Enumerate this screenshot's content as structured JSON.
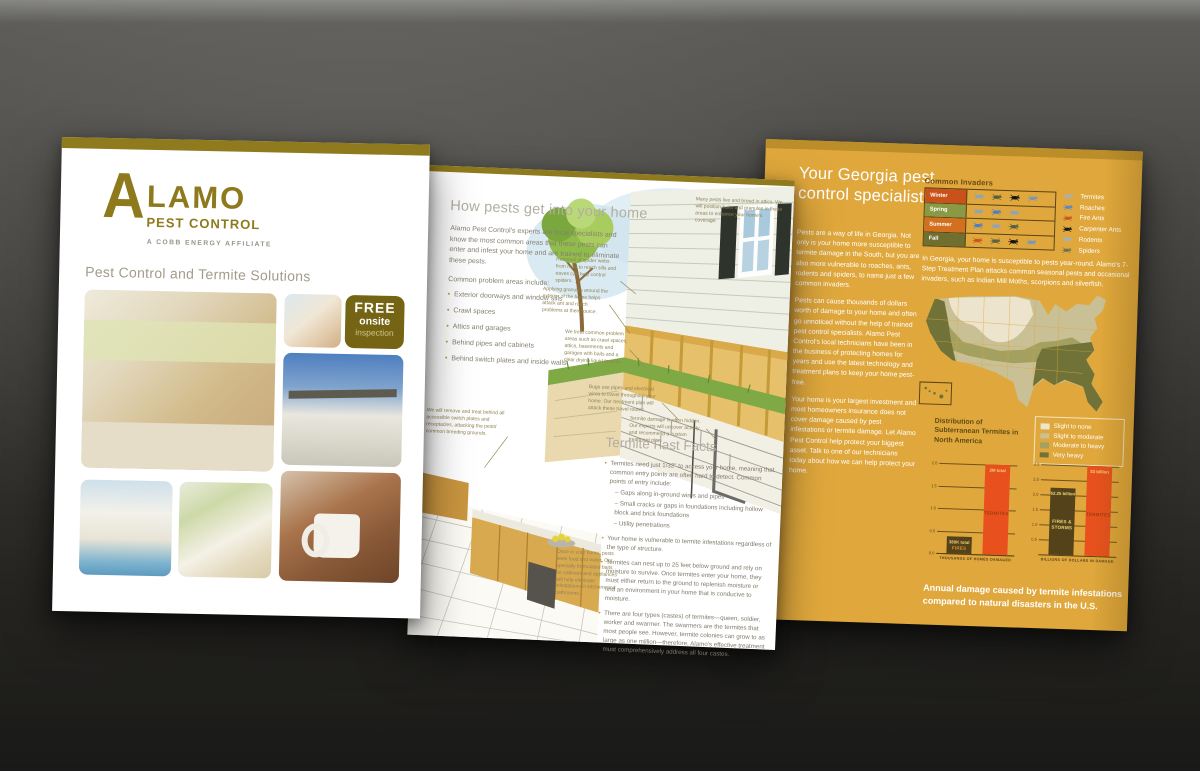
{
  "page1": {
    "logo": {
      "initial": "A",
      "word": "LAMO",
      "sub": "PEST CONTROL",
      "tagline": "A COBB ENERGY AFFILIATE"
    },
    "heading": "Pest Control and Termite Solutions",
    "badge": {
      "line1": "FREE",
      "line2": "onsite",
      "line3": "inspection"
    },
    "photos": [
      "family cooking in kitchen",
      "parents and daughter",
      "two-story house",
      "house with pool",
      "woman with dog",
      "woman holding mug"
    ]
  },
  "page2": {
    "heading": "How pests get into your home",
    "intro": "Alamo Pest Control's experts are local specialists and know the most common areas that these pests can enter and infest your home and are trained to eliminate these pests.",
    "list_intro": "Common problem areas include:",
    "bullets": [
      "Exterior doorways and window sills",
      "Crawl spaces",
      "Attics and garages",
      "Behind pipes and cabinets",
      "Behind switch plates and inside walls"
    ],
    "annotations": {
      "attic": "Many pests live and breed in attics. We will position baits and granules in these areas to enhance your home's coverage.",
      "spider": "Removal of spider webs from hard to reach sills and eaves can help control spiders.",
      "granules": "Applying granules around the exterior of the home helps attack ant and roach problems at their source.",
      "treat": "We treat common problem areas such as crawl spaces, attics, basements and garages with baits and a clear drying liquid formula.",
      "switches": "We will remove and treat behind all accessible switch plates and receptacles, attacking the pests' common breeding grounds.",
      "pipes": "Bugs use pipes and electrical wires to travel throughout your home. Our treatment plan will attack these travel routes.",
      "hidden": "Termite damage is often hidden. Our experts will uncover activity and recommend a custom treatment plan.",
      "kitchen": "Once in your home, pests seek food and water. Our specially formulated baits for cabinets and appliances will help eliminate infestations in kitchens and bathrooms."
    },
    "facts_heading": "Termite Fast Facts",
    "facts": [
      {
        "text": "Termites need just 1/32\" to access your home, meaning that common entry points are often hard to detect. Common points of entry include:",
        "subs": [
          "– Gaps along in-ground wires and pipes",
          "– Small cracks or gaps in foundations including hollow block and brick foundations",
          "– Utility penetrations"
        ]
      },
      {
        "text": "Your home is vulnerable to termite infestations regardless of the type of structure."
      },
      {
        "text": "Termites can nest up to 25 feet below ground and rely on moisture to survive. Once termites enter your home, they must either return to the ground to replenish moisture or find an environment in your home that is conducive to moisture."
      },
      {
        "text": "There are four types (castes) of termites—queen, soldier, worker and swarmer. The swarmers are the termites that most people see. However, termite colonies can grow to as large as one million—therefore, Alamo's effective treatment must comprehensively address all four castes."
      }
    ]
  },
  "page3": {
    "heading_line1": "Your Georgia pest",
    "heading_line2": "control specialists",
    "paragraphs": [
      "Pests are a way of life in Georgia. Not only is your home more susceptible to termite damage in the South, but you are also more vulnerable to roaches, ants, rodents and spiders, to name just a few common invaders.",
      "Pests can cause thousands of dollars worth of damage to your home and often go unnoticed without the help of trained pest control specialists. Alamo Pest Control's local technicians have been in the business of protecting homes for years and use the latest technology and treatment plans to keep your home pest-free.",
      "Your home is your largest investment and most homeowners insurance does not cover damage caused by pest infestations or termite damage. Let Alamo Pest Control help protect your biggest asset. Talk to one of our technicians today about how we can help protect your home."
    ],
    "invaders": {
      "title": "Common Invaders",
      "rows": [
        {
          "label": "Winter",
          "label_color": "#c8521a",
          "icons": [
            "#8ba3bd",
            "#555d42",
            "#151515",
            "#7b97b4"
          ]
        },
        {
          "label": "Spring",
          "label_color": "#8a9a44",
          "icons": [
            "#8ba3bd",
            "#4f7ec9",
            "#8ba3bd"
          ]
        },
        {
          "label": "Summer",
          "label_color": "#d3701f",
          "icons": [
            "#4f7ec9",
            "#8ba3bd",
            "#555d42"
          ]
        },
        {
          "label": "Fall",
          "label_color": "#6f7030",
          "icons": [
            "#c8561e",
            "#5a6140",
            "#151515",
            "#7b97b4"
          ]
        }
      ],
      "legend": [
        {
          "label": "Termites",
          "color": "#9fb3c5"
        },
        {
          "label": "Roaches",
          "color": "#5f86c0"
        },
        {
          "label": "Fire Ants",
          "color": "#c8561e"
        },
        {
          "label": "Carpenter Ants",
          "color": "#1a1a1a"
        },
        {
          "label": "Rodents",
          "color": "#9fb3c5"
        },
        {
          "label": "Spiders",
          "color": "#6e744e"
        }
      ]
    },
    "georgia_note": "In Georgia, your home is susceptible to pests year-round. Alamo's 7-Step Treatment Plan attacks common seasonal pests and occasional invaders, such as Indian Mill Moths, scorpions and silverfish.",
    "map_title": "Distribution of Subterranean Termites in North America",
    "map_legend": [
      {
        "label": "Slight to none",
        "color": "#ece4cd"
      },
      {
        "label": "Slight to moderate",
        "color": "#c9c096"
      },
      {
        "label": "Moderate to heavy",
        "color": "#a3a060"
      },
      {
        "label": "Very heavy",
        "color": "#707238"
      }
    ],
    "caption": "Annual damage caused by termite infestations compared to natural disasters in the U.S."
  },
  "chart_data": [
    {
      "type": "bar",
      "title": "Homes damaged annually",
      "xlabel": "THOUSANDS OF HOMES DAMAGED",
      "ylabel": "",
      "ylim": [
        0,
        2.0
      ],
      "yticks": [
        0.0,
        0.5,
        1.0,
        1.5,
        2.0
      ],
      "grid": true,
      "bars": [
        {
          "name": "FIRES",
          "value": 0.38,
          "value_label": "380K total",
          "color": "#54431a",
          "value_color": "#f2d479",
          "name_color": "#e08a2e"
        },
        {
          "name": "TERMITES",
          "value": 2.0,
          "value_label": "2M total",
          "color": "#e8511d",
          "value_color": "#f2d479",
          "name_color": "#a23c10"
        }
      ]
    },
    {
      "type": "bar",
      "title": "Dollars of damage annually",
      "xlabel": "BILLIONS OF DOLLARS IN DAMAGE",
      "ylabel": "",
      "ylim": [
        0,
        3.0
      ],
      "yticks": [
        0.5,
        1.0,
        1.5,
        2.0,
        2.5,
        3.0
      ],
      "grid": true,
      "bars": [
        {
          "name": "FIRES & STORMS",
          "value": 2.25,
          "value_label": "$2.25 billion",
          "color": "#54431a",
          "value_color": "#f2d479",
          "name_color": "#f2d479"
        },
        {
          "name": "TERMITES",
          "value": 3.0,
          "value_label": "$3 billion",
          "color": "#e8511d",
          "value_color": "#f2d479",
          "name_color": "#a23c10"
        }
      ]
    }
  ],
  "colors": {
    "brand_olive": "#8f7a1d",
    "gold_page": "#e0a83c",
    "termite_orange": "#e8511d",
    "dark_bar": "#54431a"
  }
}
